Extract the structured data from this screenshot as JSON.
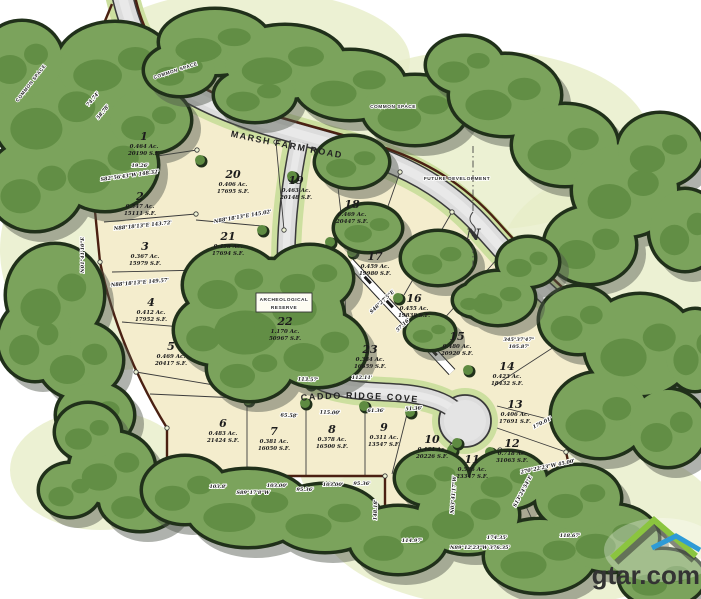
{
  "watermark": {
    "text": "gtar.com"
  },
  "map": {
    "type": "subdivision-plat",
    "roads": {
      "marsh_farm": "MARSH FARM ROAD",
      "caddo_ridge": "CADDO RIDGE COVE"
    },
    "annotations": {
      "common_space": [
        {
          "text": "COMMON SPACE",
          "x": 32,
          "y": 84,
          "r": -52
        },
        {
          "text": "COMMON SPACE",
          "x": 176,
          "y": 72,
          "r": -18
        },
        {
          "text": "COMMON SPACE",
          "x": 393,
          "y": 108,
          "r": 0
        }
      ],
      "future_development": {
        "text": "FUTURE DEVELOPMENT"
      },
      "reserve": {
        "line1": "ARCHEOLOGICAL",
        "line2": "RESERVE"
      },
      "north_label": "N"
    },
    "lots": [
      {
        "num": "1",
        "acres": "0.464 Ac.",
        "sqft": "20190 S.F.",
        "x": 144,
        "y": 140
      },
      {
        "num": "2",
        "acres": "0.347 Ac.",
        "sqft": "15111 S.F.",
        "x": 140,
        "y": 200
      },
      {
        "num": "3",
        "acres": "0.367 Ac.",
        "sqft": "15979 S.F.",
        "x": 145,
        "y": 250
      },
      {
        "num": "4",
        "acres": "0.412 Ac.",
        "sqft": "17952 S.F.",
        "x": 151,
        "y": 306
      },
      {
        "num": "5",
        "acres": "0.469 Ac.",
        "sqft": "20417 S.F.",
        "x": 171,
        "y": 350
      },
      {
        "num": "6",
        "acres": "0.483 Ac.",
        "sqft": "21424 S.F.",
        "x": 223,
        "y": 427
      },
      {
        "num": "7",
        "acres": "0.381 Ac.",
        "sqft": "16050 S.F.",
        "x": 274,
        "y": 435
      },
      {
        "num": "8",
        "acres": "0.378 Ac.",
        "sqft": "16500 S.F.",
        "x": 332,
        "y": 433
      },
      {
        "num": "9",
        "acres": "0.311 Ac.",
        "sqft": "13547 S.F.",
        "x": 384,
        "y": 431
      },
      {
        "num": "10",
        "acres": "0.464 Ac.",
        "sqft": "20226 S.F.",
        "x": 432,
        "y": 443
      },
      {
        "num": "11",
        "acres": "0.536 Ac.",
        "sqft": "23347 S.F.",
        "x": 472,
        "y": 463
      },
      {
        "num": "12",
        "acres": "0.718 Ac.",
        "sqft": "31063 S.F.",
        "x": 512,
        "y": 447
      },
      {
        "num": "13",
        "acres": "0.406 Ac.",
        "sqft": "17691 S.F.",
        "x": 515,
        "y": 408
      },
      {
        "num": "14",
        "acres": "0.423 Ac.",
        "sqft": "18432 S.F.",
        "x": 507,
        "y": 370
      },
      {
        "num": "15",
        "acres": "0.480 Ac.",
        "sqft": "20920 S.F.",
        "x": 457,
        "y": 340
      },
      {
        "num": "16",
        "acres": "0.455 Ac.",
        "sqft": "19838 S.F.",
        "x": 414,
        "y": 302
      },
      {
        "num": "17",
        "acres": "0.459 Ac.",
        "sqft": "19980 S.F.",
        "x": 375,
        "y": 260
      },
      {
        "num": "18",
        "acres": "0.469 Ac.",
        "sqft": "20447 S.F.",
        "x": 352,
        "y": 208
      },
      {
        "num": "19",
        "acres": "0.463 Ac.",
        "sqft": "20148 S.F.",
        "x": 296,
        "y": 184
      },
      {
        "num": "20",
        "acres": "0.406 Ac.",
        "sqft": "17695 S.F.",
        "x": 233,
        "y": 178
      },
      {
        "num": "21",
        "acres": "0.458 Ac.",
        "sqft": "17694 S.F.",
        "x": 228,
        "y": 240
      },
      {
        "num": "22",
        "acres": "1.170 Ac.",
        "sqft": "50967 S.F.",
        "x": 285,
        "y": 325
      },
      {
        "num": "23",
        "acres": "0.384 Ac.",
        "sqft": "16659 S.F.",
        "x": 370,
        "y": 353
      }
    ],
    "dimensions": [
      {
        "t": "74.74'",
        "x": 94,
        "y": 100,
        "r": -50
      },
      {
        "t": "58.78'",
        "x": 104,
        "y": 113,
        "r": -50
      },
      {
        "t": "N01°41'10\"E",
        "x": 84,
        "y": 255,
        "r": -90
      },
      {
        "t": "19.26'",
        "x": 140,
        "y": 167,
        "r": 0
      },
      {
        "t": "S82°56'43\"W 148.32'",
        "x": 130,
        "y": 177,
        "r": -8
      },
      {
        "t": "N88°18'13\"E 143.72'",
        "x": 143,
        "y": 227,
        "r": -6
      },
      {
        "t": "N88°18'13\"E 149.57'",
        "x": 140,
        "y": 284,
        "r": -5
      },
      {
        "t": "N88°18'13\"E 145.02'",
        "x": 243,
        "y": 218,
        "r": -10
      },
      {
        "t": "65.58'",
        "x": 289,
        "y": 417,
        "r": 3
      },
      {
        "t": "115.00'",
        "x": 330,
        "y": 414,
        "r": 2
      },
      {
        "t": "61.36'",
        "x": 376,
        "y": 412,
        "r": 0
      },
      {
        "t": "51.36'",
        "x": 414,
        "y": 410,
        "r": -3
      },
      {
        "t": "113.57'",
        "x": 308,
        "y": 381,
        "r": 2
      },
      {
        "t": "112.11'",
        "x": 362,
        "y": 379,
        "r": 0
      },
      {
        "t": "345°37'47\"",
        "x": 519,
        "y": 341,
        "r": 0
      },
      {
        "t": "105.87'",
        "x": 519,
        "y": 348,
        "r": 0
      },
      {
        "t": "170.01'",
        "x": 543,
        "y": 424,
        "r": -27
      },
      {
        "t": "270°22'23\"W 45.00'",
        "x": 548,
        "y": 468,
        "r": -12
      },
      {
        "t": "103.8'",
        "x": 218,
        "y": 488,
        "r": 0
      },
      {
        "t": "S89°17'8\"W",
        "x": 253,
        "y": 494,
        "r": 0
      },
      {
        "t": "103.00'",
        "x": 277,
        "y": 487,
        "r": 0
      },
      {
        "t": "95.36'",
        "x": 305,
        "y": 491,
        "r": 0
      },
      {
        "t": "103.00'",
        "x": 333,
        "y": 486,
        "r": 0
      },
      {
        "t": "95.36'",
        "x": 362,
        "y": 485,
        "r": 0
      },
      {
        "t": "148.18'",
        "x": 377,
        "y": 510,
        "r": -88
      },
      {
        "t": "114.97'",
        "x": 412,
        "y": 542,
        "r": 0
      },
      {
        "t": "174.35'",
        "x": 497,
        "y": 539,
        "r": 0
      },
      {
        "t": "N89°12'23\"W 376.35'",
        "x": 480,
        "y": 549,
        "r": 0
      },
      {
        "t": "118.67'",
        "x": 570,
        "y": 537,
        "r": 0
      },
      {
        "t": "S13°24'54\"E",
        "x": 524,
        "y": 492,
        "r": -62
      },
      {
        "t": "N03°41'17\"W",
        "x": 455,
        "y": 495,
        "r": -86
      },
      {
        "t": "S46°27'5\"E",
        "x": 383,
        "y": 303,
        "r": -43
      },
      {
        "t": "57.16'",
        "x": 404,
        "y": 326,
        "r": -43
      }
    ],
    "colors": {
      "tree_green": "#7ba35c",
      "tree_dark": "#5e8b41",
      "tree_outline": "#20301a",
      "lot_cream": "#f4edcd",
      "road_gray": "#dcdcdc",
      "verge_green": "#ccdf9f",
      "boundary_brown": "#4a2012",
      "shadow_gray": "#50564b",
      "logo_green": "#8bc53f",
      "logo_blue": "#2e9bd6"
    }
  }
}
